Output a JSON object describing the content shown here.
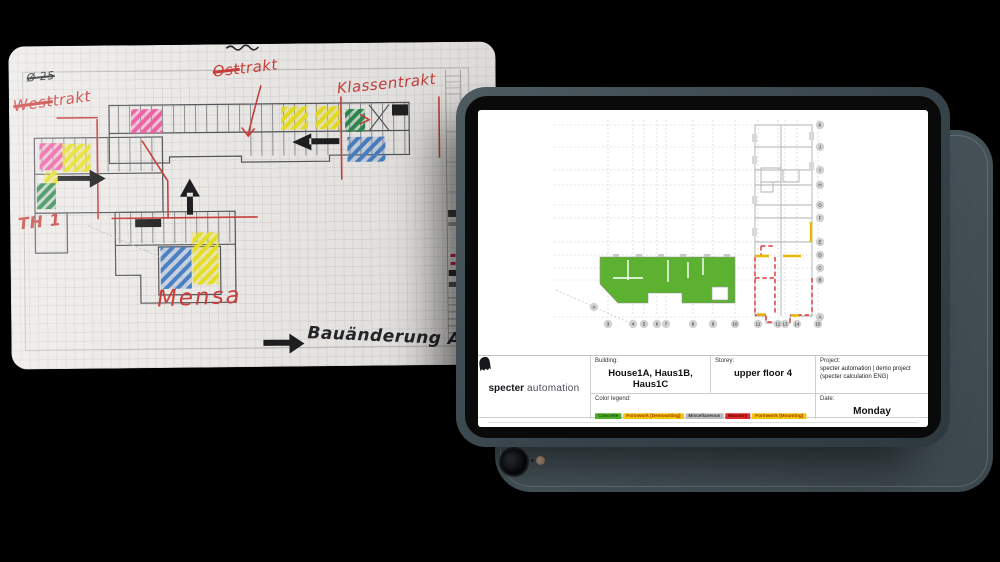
{
  "paper_note": {
    "pencil_scribble": "Ø 25",
    "west_wing": {
      "struck": "West",
      "rest": "trakt"
    },
    "east_wing": {
      "struck": "Ost",
      "rest": "trakt"
    },
    "class_wing_label": "Klassentrakt",
    "hall_label": "TH 1",
    "mensa_label": "Mensa",
    "handwritten_note": "Bauänderung Ab"
  },
  "tablet": {
    "logo": {
      "brand_bold": "specter",
      "brand_light": "automation"
    },
    "infobar": {
      "building_label": "Building:",
      "building_value": "House1A, Haus1B, Haus1C",
      "storey_label": "Storey:",
      "storey_value": "upper floor 4",
      "project_label": "Project:",
      "project_value": "specter automation | demo project (specter calculation ENG)",
      "date_label": "Date:",
      "date_day": "Monday",
      "date_value": "01/15/2024",
      "legend_label": "Color legend:",
      "legend": [
        {
          "label": "Concrete",
          "bg": "#4fae27",
          "fg": "#17500a"
        },
        {
          "label": "Formwork (Demounting)",
          "bg": "#f0c40f",
          "fg": "#a33b00"
        },
        {
          "label": "Miscellaneous",
          "bg": "#bcbcbc",
          "fg": "#3a3a3a"
        },
        {
          "label": "Masonry",
          "bg": "#df2b2b",
          "fg": "#5e0000"
        },
        {
          "label": "Formwork (Mounting)",
          "bg": "#f0c40f",
          "fg": "#a33b00"
        }
      ]
    },
    "plan": {
      "row_labels": [
        "K",
        "J",
        "I",
        "H",
        "G",
        "F",
        "E",
        "D",
        "C",
        "B",
        "A"
      ],
      "col_labels": [
        "3",
        "4",
        "5",
        "6",
        "7",
        "8",
        "9",
        "10",
        "11",
        "12",
        "13",
        "14",
        "15"
      ],
      "site_marker": "A",
      "status_colors": {
        "concrete_done": "#5cb230",
        "masonry": "#e23b3b",
        "formwork": "#e9b800"
      }
    }
  }
}
